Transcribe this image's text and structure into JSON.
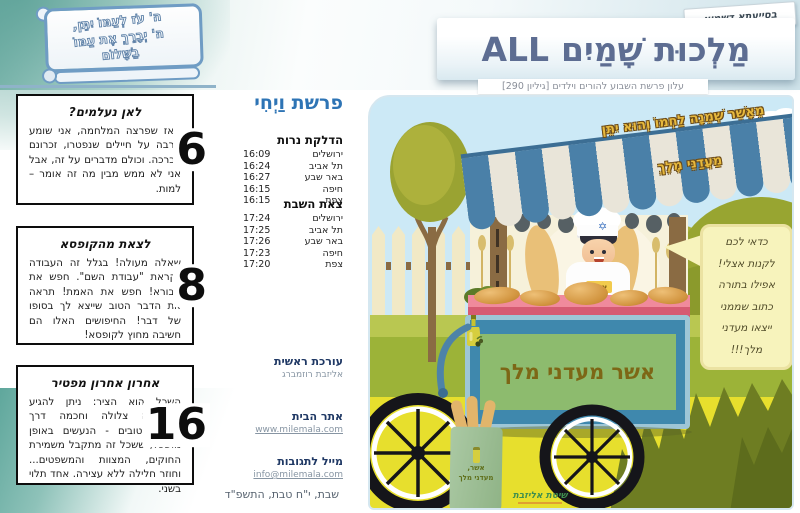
{
  "header": {
    "badge": "בסייעתא דשמיא",
    "title_latin": "ALL",
    "title_hebrew": "מַלְכוּת שָׁמַיִם",
    "subtitle": "עלון פרשת השבוע להורים וילדים [גיליון 290]"
  },
  "scroll_verse": {
    "line1": "ה' עֹז לְעַמּוֹ יִתֵּן,",
    "line2": "ה' יְבָרֵךְ אֶת עַמּוֹ",
    "line3": "בַשָּׁלוֹם"
  },
  "question_boxes": [
    {
      "number": "6",
      "title": "לאן נעלמים?",
      "body": "מאז שפרצה המלחמה, אני שומע הרבה על חיילים שנפטרו, זכרונם לברכה. וכולם מדברים על זה, אבל אני לא ממש מבין מה זה אומר – למות."
    },
    {
      "number": "8",
      "title": "לצאת מהקופסא",
      "body": "שאלה מעולה! בגלל זה העבודה נקראת \"עבודת השם\". חפש את הבורא! חפש את האמת! תראה את הדבר הטוב שייצא לך בסופו של דבר! החיפושים האלו הם חשיבה מחוץ לקופסא!"
    },
    {
      "number": "16",
      "title": "אחרון אחרון מפטיר",
      "body": "השכל הוא הציר: ניתן להגיע למחשבה צלולה וחכמה דרך מעשים טובים - הנעשים באופן מושכל, ששכל זה מתקבל משמירת החוקים, המצוות והמשפטים... וחוזר חלילה ללא עצירה. אחד תלוי בשני."
    }
  ],
  "middle_column": {
    "parsha_title": "פרשת וַיְחִי",
    "candle_lighting": {
      "header": "הדלקת נרות",
      "rows": [
        {
          "city": "ירושלים",
          "time": "16:09"
        },
        {
          "city": "תל אביב",
          "time": "16:24"
        },
        {
          "city": "באר שבע",
          "time": "16:27"
        },
        {
          "city": "חיפה",
          "time": "16:15"
        },
        {
          "city": "צפת",
          "time": "16:15"
        }
      ]
    },
    "shabbat_end": {
      "header": "צאת השבת",
      "rows": [
        {
          "city": "ירושלים",
          "time": "17:24"
        },
        {
          "city": "תל אביב",
          "time": "17:25"
        },
        {
          "city": "באר שבע",
          "time": "17:26"
        },
        {
          "city": "חיפה",
          "time": "17:23"
        },
        {
          "city": "צפת",
          "time": "17:20"
        }
      ]
    },
    "editor": {
      "header": "עורכת ראשית",
      "name": "אליזבת רוזמברג"
    },
    "website": {
      "header": "אתר הבית",
      "url": "www.milemala.com"
    },
    "email": {
      "header": "מייל לתגובות",
      "address": "info@milemala.com"
    },
    "date_line": "שבת, י\"ח טבת, התשפ\"ד"
  },
  "illustration": {
    "verse_line1": "מֵאָשֵׁר שְׁמֵנָה לַחְמוֹ וְהוּא יִתֵּן",
    "verse_line2": "מַעֲדַנֵּי מֶלֶךְ",
    "speech_bubble_lines": [
      "כדאי לכם",
      "לקנות אצלי!",
      "אפילו בתורה",
      "כתוב שממני",
      "ייצאו מעדני",
      "מלך!!!"
    ],
    "cart_sign_right": "אשר",
    "cart_sign_left": "מעדני מלך",
    "apron_label": "אשר",
    "bag_line1": "אשר,",
    "bag_line2": "מעדני מלך",
    "logo_text": "שיטת אליזבת"
  },
  "colors": {
    "title_blue": "#5d6d92",
    "parsha_blue": "#2e74b5",
    "info_header_navy": "#1f3864",
    "teal_wash": "#79b4ab",
    "sky": "#cce9f6",
    "ground_yellow": "#e7df2d",
    "verse_gold": "#e7b93d",
    "awning_blue": "#4a80a8",
    "cart_blue": "#3f88ad",
    "sign_green": "#8dbb6e",
    "bubble_yellow": "#f7f3bc"
  }
}
